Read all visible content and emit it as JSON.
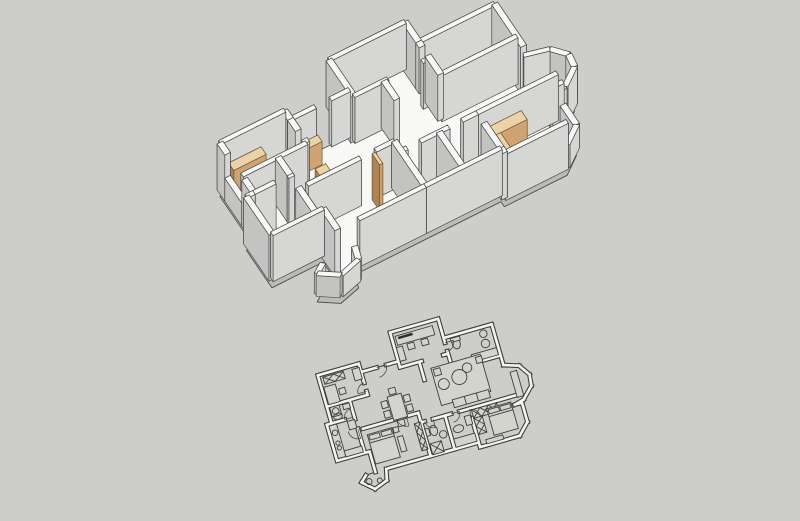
{
  "scene": {
    "width": 800,
    "height": 521,
    "description": "3d-apartment-model-over-2d-floorplan"
  },
  "colors": {
    "background": "#cdcec9",
    "line3d": "#4d4d4d",
    "floor": "#f8f8f6",
    "slabSide": "#bcbcb7",
    "wall": {
      "top": "#f7f7f5",
      "lit": "#ebebe9",
      "mid": "#d6d6d4",
      "dark": "#c3c3c1"
    },
    "wood": {
      "top": "#ecd2a8",
      "lit": "#e2bc8c",
      "mid": "#cfa472",
      "dark": "#ae8455",
      "line": "#6f5a36"
    },
    "planLine": "#3e3e3e",
    "planWallFill": "#f4f4f1",
    "planFurnFill": "#d3d4ce",
    "planDarkFill": "#2e2e2e"
  },
  "projection": {
    "origin3d": [
      196,
      172
    ],
    "U": [
      19,
      -9.5
    ],
    "V": [
      8.5,
      12.5
    ],
    "wallHeight": 46,
    "slabDrop": 8,
    "plan2d": {
      "center": [
        427,
        398
      ],
      "scale": 12.5,
      "rotation": -16,
      "planCenter": [
        8.4,
        5.85
      ]
    }
  },
  "plan": {
    "outline": [
      [
        7.0,
        0
      ],
      [
        11.0,
        0
      ],
      [
        11.0,
        1.6
      ],
      [
        15.0,
        1.6
      ],
      [
        15.0,
        5.0
      ],
      [
        16.2,
        5.4
      ],
      [
        16.8,
        6.3
      ],
      [
        16.7,
        7.2
      ],
      [
        15.8,
        8.1
      ],
      [
        15.6,
        8.3
      ],
      [
        15.6,
        9.9
      ],
      [
        14.7,
        10.8
      ],
      [
        11.4,
        10.8
      ],
      [
        11.4,
        10.4
      ],
      [
        7.4,
        10.4
      ],
      [
        3.7,
        10.4
      ],
      [
        3.5,
        11.3
      ],
      [
        2.4,
        11.7
      ],
      [
        1.5,
        10.9
      ],
      [
        2.0,
        10.45
      ],
      [
        2.8,
        10.4
      ],
      [
        2.8,
        8.7
      ],
      [
        0.1,
        8.7
      ],
      [
        0.1,
        5.7
      ],
      [
        0.5,
        5.7
      ],
      [
        0.5,
        1.7
      ],
      [
        3.9,
        1.7
      ],
      [
        3.9,
        2.4
      ],
      [
        7.0,
        2.4
      ]
    ],
    "walls": [
      {
        "p": [
          7.0,
          0,
          11.0,
          0
        ]
      },
      {
        "p": [
          7.0,
          0,
          7.0,
          2.9
        ]
      },
      {
        "p": [
          11.0,
          0,
          11.0,
          1.6
        ]
      },
      {
        "p": [
          11.0,
          1.6,
          15.0,
          1.6
        ]
      },
      {
        "p": [
          15.0,
          1.6,
          15.0,
          5.0
        ]
      },
      {
        "p": [
          15.0,
          5.0,
          16.2,
          5.4
        ],
        "h": 0.8
      },
      {
        "p": [
          16.2,
          5.4,
          16.8,
          6.3
        ],
        "h": 0.8
      },
      {
        "p": [
          16.8,
          6.3,
          16.7,
          7.2
        ],
        "h": 0.8
      },
      {
        "p": [
          16.7,
          7.2,
          15.8,
          8.1
        ],
        "h": 0.8
      },
      {
        "p": [
          15.8,
          8.1,
          15.0,
          8.3
        ],
        "h": 0.8
      },
      {
        "p": [
          15.0,
          8.3,
          15.6,
          8.3
        ]
      },
      {
        "p": [
          15.6,
          8.3,
          15.6,
          9.9
        ],
        "h": 0.5
      },
      {
        "p": [
          15.6,
          9.9,
          14.7,
          10.8
        ],
        "h": 0.5
      },
      {
        "p": [
          14.7,
          10.8,
          11.4,
          10.8
        ]
      },
      {
        "p": [
          11.4,
          10.8,
          11.4,
          10.4
        ]
      },
      {
        "p": [
          11.4,
          10.4,
          7.4,
          10.4
        ]
      },
      {
        "p": [
          7.4,
          10.4,
          3.9,
          10.4
        ]
      },
      {
        "p": [
          3.7,
          10.4,
          3.5,
          11.3
        ],
        "h": 0.45
      },
      {
        "p": [
          3.5,
          11.3,
          2.4,
          11.7
        ],
        "h": 0.45
      },
      {
        "p": [
          2.4,
          11.7,
          1.5,
          10.9
        ],
        "h": 0.45
      },
      {
        "p": [
          1.5,
          10.9,
          2.0,
          10.45
        ],
        "h": 0.45
      },
      {
        "p": [
          2.8,
          10.4,
          2.8,
          8.7
        ]
      },
      {
        "p": [
          2.8,
          8.7,
          0.1,
          8.7
        ]
      },
      {
        "p": [
          0.1,
          8.7,
          0.1,
          5.7
        ]
      },
      {
        "p": [
          0.1,
          5.7,
          0.5,
          5.7
        ]
      },
      {
        "p": [
          0.5,
          5.7,
          0.5,
          4.6
        ]
      },
      {
        "p": [
          0.5,
          4.6,
          0.5,
          2.6
        ],
        "h": 0.5
      },
      {
        "p": [
          0.5,
          2.6,
          0.5,
          1.7
        ]
      },
      {
        "p": [
          0.5,
          1.7,
          3.9,
          1.7
        ]
      },
      {
        "p": [
          3.9,
          1.7,
          3.9,
          2.4
        ]
      },
      {
        "p": [
          3.9,
          2.4,
          5.2,
          2.4
        ]
      },
      {
        "p": [
          6.0,
          2.4,
          7.0,
          2.4
        ]
      },
      {
        "p": [
          7.0,
          2.9,
          8.8,
          2.9
        ]
      },
      {
        "p": [
          10.6,
          2.9,
          11.0,
          2.9
        ]
      },
      {
        "p": [
          11.0,
          1.6,
          11.0,
          2.0
        ]
      },
      {
        "p": [
          11.0,
          2.7,
          11.0,
          4.2
        ]
      },
      {
        "p": [
          11.0,
          4.2,
          15.0,
          4.2
        ]
      },
      {
        "p": [
          8.6,
          2.9,
          8.6,
          4.4
        ]
      },
      {
        "p": [
          11.4,
          7.6,
          15.6,
          7.6
        ]
      },
      {
        "p": [
          11.4,
          8.4,
          11.4,
          10.8
        ]
      },
      {
        "p": [
          7.4,
          7.6,
          7.7,
          7.6
        ]
      },
      {
        "p": [
          8.4,
          7.6,
          9.9,
          7.6
        ]
      },
      {
        "p": [
          10.6,
          7.6,
          11.4,
          7.6
        ]
      },
      {
        "p": [
          9.4,
          7.6,
          9.4,
          10.4
        ]
      },
      {
        "p": [
          7.4,
          6.8,
          7.4,
          10.4
        ]
      },
      {
        "p": [
          2.8,
          6.8,
          5.6,
          6.8
        ]
      },
      {
        "p": [
          6.4,
          6.8,
          7.4,
          6.8
        ]
      },
      {
        "p": [
          0.5,
          4.3,
          3.9,
          4.3
        ]
      },
      {
        "p": [
          3.9,
          2.4,
          3.9,
          3.3
        ]
      },
      {
        "p": [
          3.9,
          4.0,
          3.9,
          4.3
        ]
      },
      {
        "p": [
          0.5,
          5.7,
          1.6,
          5.7
        ]
      },
      {
        "p": [
          2.4,
          4.3,
          2.4,
          5.7
        ]
      },
      {
        "p": [
          2.4,
          5.7,
          2.4,
          5.9
        ]
      },
      {
        "p": [
          2.4,
          6.7,
          2.4,
          8.7
        ]
      }
    ],
    "boxes": [
      {
        "name": "wardrobe-bedroom2",
        "r": [
          0.85,
          1.95,
          1.7,
          0.6
        ],
        "h": 0.55
      },
      {
        "name": "hall-cabinet-a",
        "r": [
          4.15,
          2.8,
          1.0,
          0.52
        ],
        "h": 0.5
      },
      {
        "name": "hall-cabinet-b",
        "r": [
          4.15,
          4.75,
          0.55,
          0.85
        ],
        "h": 0.5
      },
      {
        "name": "master-door-leaf",
        "r": [
          6.18,
          6.92,
          0.16,
          0.88
        ],
        "h": 1.0
      },
      {
        "name": "wardrobe-bedroom3-a",
        "r": [
          11.55,
          7.75,
          2.1,
          0.7
        ],
        "h": 0.62
      },
      {
        "name": "wardrobe-bedroom3-b",
        "r": [
          11.55,
          8.45,
          0.7,
          1.35
        ],
        "h": 0.62
      },
      {
        "name": "bath-cabinet",
        "r": [
          11.15,
          1.8,
          0.6,
          0.38
        ],
        "h": 0.32
      }
    ],
    "furniture": [
      {
        "k": "rect",
        "r": [
          7.3,
          0.4,
          3.1,
          0.75
        ]
      },
      {
        "k": "bar",
        "r": [
          7.5,
          0.5,
          1.2,
          0.2
        ]
      },
      {
        "k": "rect",
        "r": [
          8.05,
          1.25,
          0.55,
          0.5
        ]
      },
      {
        "k": "rect",
        "r": [
          9.2,
          1.25,
          0.55,
          0.5
        ]
      },
      {
        "k": "rect",
        "r": [
          7.15,
          1.3,
          0.5,
          1.15
        ]
      },
      {
        "k": "circle",
        "c": [
          14.15,
          2.15,
          0.3
        ]
      },
      {
        "k": "circle",
        "c": [
          14.1,
          2.95,
          0.34
        ]
      },
      {
        "k": "ellipse",
        "c": [
          11.85,
          2.3
        ],
        "rr": [
          0.32,
          0.44
        ]
      },
      {
        "k": "rect",
        "r": [
          11.5,
          1.8,
          0.75,
          0.32
        ]
      },
      {
        "k": "rect",
        "r": [
          12.75,
          3.5,
          2.1,
          0.6
        ]
      },
      {
        "k": "rect",
        "r": [
          9.35,
          3.65,
          4.1,
          3.1
        ]
      },
      {
        "k": "circle",
        "c": [
          11.35,
          4.95,
          0.6
        ]
      },
      {
        "k": "circle",
        "c": [
          12.15,
          4.4,
          0.38
        ]
      },
      {
        "k": "circle",
        "c": [
          10.0,
          5.15,
          0.44
        ]
      },
      {
        "k": "rect",
        "r": [
          10.3,
          6.55,
          3.0,
          0.65
        ]
      },
      {
        "k": "line",
        "p": [
          11.3,
          6.55,
          11.3,
          7.2
        ]
      },
      {
        "k": "line",
        "p": [
          12.3,
          6.55,
          12.3,
          7.2
        ]
      },
      {
        "k": "rect",
        "r": [
          9.5,
          3.8,
          0.55,
          0.55
        ]
      },
      {
        "k": "rect",
        "r": [
          13.0,
          3.8,
          0.5,
          0.5
        ]
      },
      {
        "k": "rect",
        "r": [
          15.35,
          5.7,
          0.55,
          2.1
        ]
      },
      {
        "k": "rect",
        "r": [
          5.35,
          4.9,
          1.15,
          1.95
        ]
      },
      {
        "k": "rect",
        "r": [
          4.75,
          5.15,
          0.5,
          0.55
        ]
      },
      {
        "k": "rect",
        "r": [
          4.75,
          5.95,
          0.5,
          0.55
        ]
      },
      {
        "k": "rect",
        "r": [
          6.6,
          5.15,
          0.5,
          0.55
        ]
      },
      {
        "k": "rect",
        "r": [
          6.6,
          5.95,
          0.5,
          0.55
        ]
      },
      {
        "k": "rect",
        "r": [
          5.6,
          4.3,
          0.55,
          0.5
        ]
      },
      {
        "k": "rect",
        "r": [
          5.6,
          6.95,
          0.55,
          0.5
        ]
      },
      {
        "k": "hatch",
        "r": [
          0.85,
          1.95,
          1.7,
          0.6
        ]
      },
      {
        "k": "rect",
        "r": [
          0.7,
          2.75,
          0.95,
          1.45
        ]
      },
      {
        "k": "rect",
        "r": [
          1.8,
          3.2,
          0.5,
          0.5
        ]
      },
      {
        "k": "rect",
        "r": [
          3.25,
          2.0,
          0.6,
          0.95
        ]
      },
      {
        "k": "rect",
        "r": [
          0.7,
          4.45,
          0.78,
          0.78
        ]
      },
      {
        "k": "circle",
        "c": [
          1.09,
          4.84,
          0.27
        ]
      },
      {
        "k": "rect",
        "r": [
          1.75,
          4.5,
          0.55,
          0.42
        ]
      },
      {
        "k": "ellipse",
        "c": [
          1.15,
          5.3
        ],
        "rr": [
          0.36,
          0.26
        ]
      },
      {
        "k": "rect",
        "r": [
          0.25,
          5.85,
          0.62,
          2.7
        ]
      },
      {
        "k": "rect",
        "r": [
          0.87,
          8.1,
          1.45,
          0.5
        ]
      },
      {
        "k": "circle",
        "c": [
          0.56,
          6.5,
          0.22
        ]
      },
      {
        "k": "circle",
        "c": [
          0.56,
          7.35,
          0.17
        ]
      },
      {
        "k": "circle",
        "c": [
          0.56,
          7.75,
          0.17
        ]
      },
      {
        "k": "rect",
        "r": [
          1.75,
          5.9,
          0.6,
          0.7
        ]
      },
      {
        "k": "rect",
        "r": [
          3.0,
          7.35,
          2.05,
          2.45
        ]
      },
      {
        "k": "rect",
        "r": [
          3.1,
          7.45,
          0.85,
          0.38
        ]
      },
      {
        "k": "rect",
        "r": [
          4.1,
          7.45,
          0.85,
          0.38
        ]
      },
      {
        "k": "line",
        "p": [
          3.0,
          8.05,
          5.05,
          8.05
        ]
      },
      {
        "k": "rect",
        "r": [
          5.25,
          8.2,
          0.45,
          1.25
        ]
      },
      {
        "k": "hatch",
        "r": [
          6.85,
          7.55,
          0.5,
          2.25
        ]
      },
      {
        "k": "rect",
        "r": [
          5.1,
          7.4,
          0.42,
          0.42
        ]
      },
      {
        "k": "hatch",
        "r": [
          7.6,
          9.45,
          0.95,
          0.9
        ]
      },
      {
        "k": "ellipse",
        "c": [
          8.2,
          8.5
        ],
        "rr": [
          0.3,
          0.42
        ]
      },
      {
        "k": "rect",
        "r": [
          7.55,
          8.2,
          0.3,
          0.6
        ]
      },
      {
        "k": "circle",
        "c": [
          8.85,
          9.0,
          0.3
        ]
      },
      {
        "k": "rect",
        "r": [
          10.85,
          8.1,
          0.5,
          0.75
        ]
      },
      {
        "k": "ellipse",
        "c": [
          10.15,
          8.9
        ],
        "rr": [
          0.42,
          0.3
        ]
      },
      {
        "k": "rect",
        "r": [
          9.55,
          9.6,
          1.75,
          0.68
        ]
      },
      {
        "k": "hatch",
        "r": [
          11.55,
          7.75,
          2.1,
          0.7
        ]
      },
      {
        "k": "hatch",
        "r": [
          11.55,
          8.45,
          0.7,
          1.35
        ]
      },
      {
        "k": "rect",
        "r": [
          12.75,
          8.0,
          2.0,
          2.2
        ]
      },
      {
        "k": "rect",
        "r": [
          12.85,
          8.1,
          0.85,
          0.35
        ]
      },
      {
        "k": "rect",
        "r": [
          13.8,
          8.1,
          0.85,
          0.35
        ]
      },
      {
        "k": "line",
        "p": [
          12.75,
          8.65,
          14.75,
          8.65
        ]
      },
      {
        "k": "rect",
        "r": [
          12.0,
          10.35,
          1.4,
          0.35
        ]
      },
      {
        "k": "circle",
        "c": [
          2.1,
          11.0,
          0.24
        ]
      },
      {
        "k": "circle",
        "c": [
          2.95,
          11.15,
          0.2
        ]
      },
      {
        "k": "arc",
        "c": [
          5.2,
          2.4
        ],
        "r": 0.8,
        "a0": 0,
        "a1": 90
      },
      {
        "k": "arc",
        "c": [
          11.0,
          2.0
        ],
        "r": 0.7,
        "a0": 0,
        "a1": 90
      },
      {
        "k": "arc",
        "c": [
          3.9,
          4.0
        ],
        "r": 0.7,
        "a0": 180,
        "a1": 270
      },
      {
        "k": "arc",
        "c": [
          2.3,
          5.7
        ],
        "r": 0.7,
        "a0": 180,
        "a1": 270
      },
      {
        "k": "arc",
        "c": [
          2.4,
          6.7
        ],
        "r": 0.8,
        "a0": 90,
        "a1": 180
      },
      {
        "k": "arc",
        "c": [
          6.4,
          6.8
        ],
        "r": 0.8,
        "a0": 90,
        "a1": 180
      },
      {
        "k": "arc",
        "c": [
          8.4,
          7.6
        ],
        "r": 0.7,
        "a0": 90,
        "a1": 180
      },
      {
        "k": "arc",
        "c": [
          9.9,
          7.6
        ],
        "r": 0.7,
        "a0": 0,
        "a1": 90
      },
      {
        "k": "arc",
        "c": [
          11.4,
          8.4
        ],
        "r": 0.7,
        "a0": 270,
        "a1": 360
      }
    ]
  }
}
